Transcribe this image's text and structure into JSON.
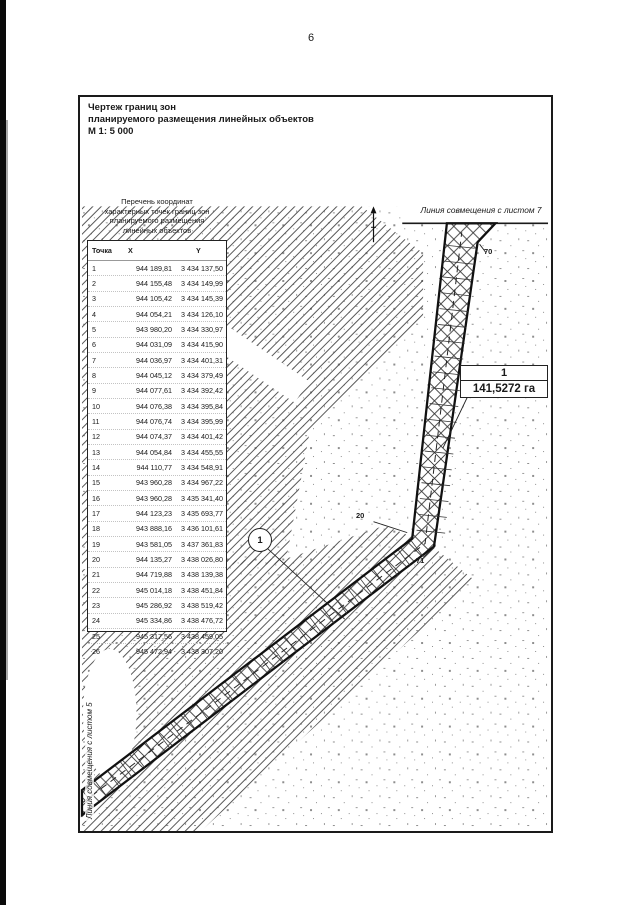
{
  "page": {
    "number": "6"
  },
  "title_block": {
    "line1": "Чертеж границ зон",
    "line2": "планируемого размещения линейных объектов",
    "line3": "М 1: 5 000"
  },
  "coords_table": {
    "title_lines": [
      "Перечень координат",
      "характерных точек границ зон",
      "планируемого размещения",
      "линейных объектов"
    ],
    "headers": [
      "Точка",
      "X",
      "Y"
    ],
    "rows": [
      [
        "1",
        "944 189,81",
        "3 434 137,50"
      ],
      [
        "2",
        "944 155,48",
        "3 434 149,99"
      ],
      [
        "3",
        "944 105,42",
        "3 434 145,39"
      ],
      [
        "4",
        "944 054,21",
        "3 434 126,10"
      ],
      [
        "5",
        "943 980,20",
        "3 434 330,97"
      ],
      [
        "6",
        "944 031,09",
        "3 434 415,90"
      ],
      [
        "7",
        "944 036,97",
        "3 434 401,31"
      ],
      [
        "8",
        "944 045,12",
        "3 434 379,49"
      ],
      [
        "9",
        "944 077,61",
        "3 434 392,42"
      ],
      [
        "10",
        "944 076,38",
        "3 434 395,84"
      ],
      [
        "11",
        "944 076,74",
        "3 434 395,99"
      ],
      [
        "12",
        "944 074,37",
        "3 434 401,42"
      ],
      [
        "13",
        "944 054,84",
        "3 434 455,55"
      ],
      [
        "14",
        "944 110,77",
        "3 434 548,91"
      ],
      [
        "15",
        "943 960,28",
        "3 434 967,22"
      ],
      [
        "16",
        "943 960,28",
        "3 435 341,40"
      ],
      [
        "17",
        "944 123,23",
        "3 435 693,77"
      ],
      [
        "18",
        "943 888,16",
        "3 436 101,61"
      ],
      [
        "19",
        "943 581,05",
        "3 437 361,83"
      ],
      [
        "20",
        "944 135,27",
        "3 438 026,80"
      ],
      [
        "21",
        "944 719,88",
        "3 438 139,38"
      ],
      [
        "22",
        "945 014,18",
        "3 438 451,84"
      ],
      [
        "23",
        "945 286,92",
        "3 438 519,42"
      ],
      [
        "24",
        "945 334,86",
        "3 438 476,72"
      ],
      [
        "25",
        "945 317,56",
        "3 438 459,05"
      ],
      [
        "26",
        "945 472,94",
        "3 438 307,20"
      ]
    ]
  },
  "map": {
    "match_line_top_label": "Линия совмещения с листом 7",
    "match_line_left_label": "Линия совмещения с листом 5",
    "zone_circle_label": "1",
    "area_box": {
      "zone_number": "1",
      "area_value": "141,5272 га"
    },
    "point_labels": {
      "top": "70",
      "bend_left": "20",
      "bend_right": "71"
    },
    "icons": {
      "north_arrow": "north-arrow"
    }
  },
  "colors": {
    "ink": "#1a1a1a",
    "hatch": "#444444",
    "stipple": "#909090",
    "paper": "#ffffff"
  }
}
